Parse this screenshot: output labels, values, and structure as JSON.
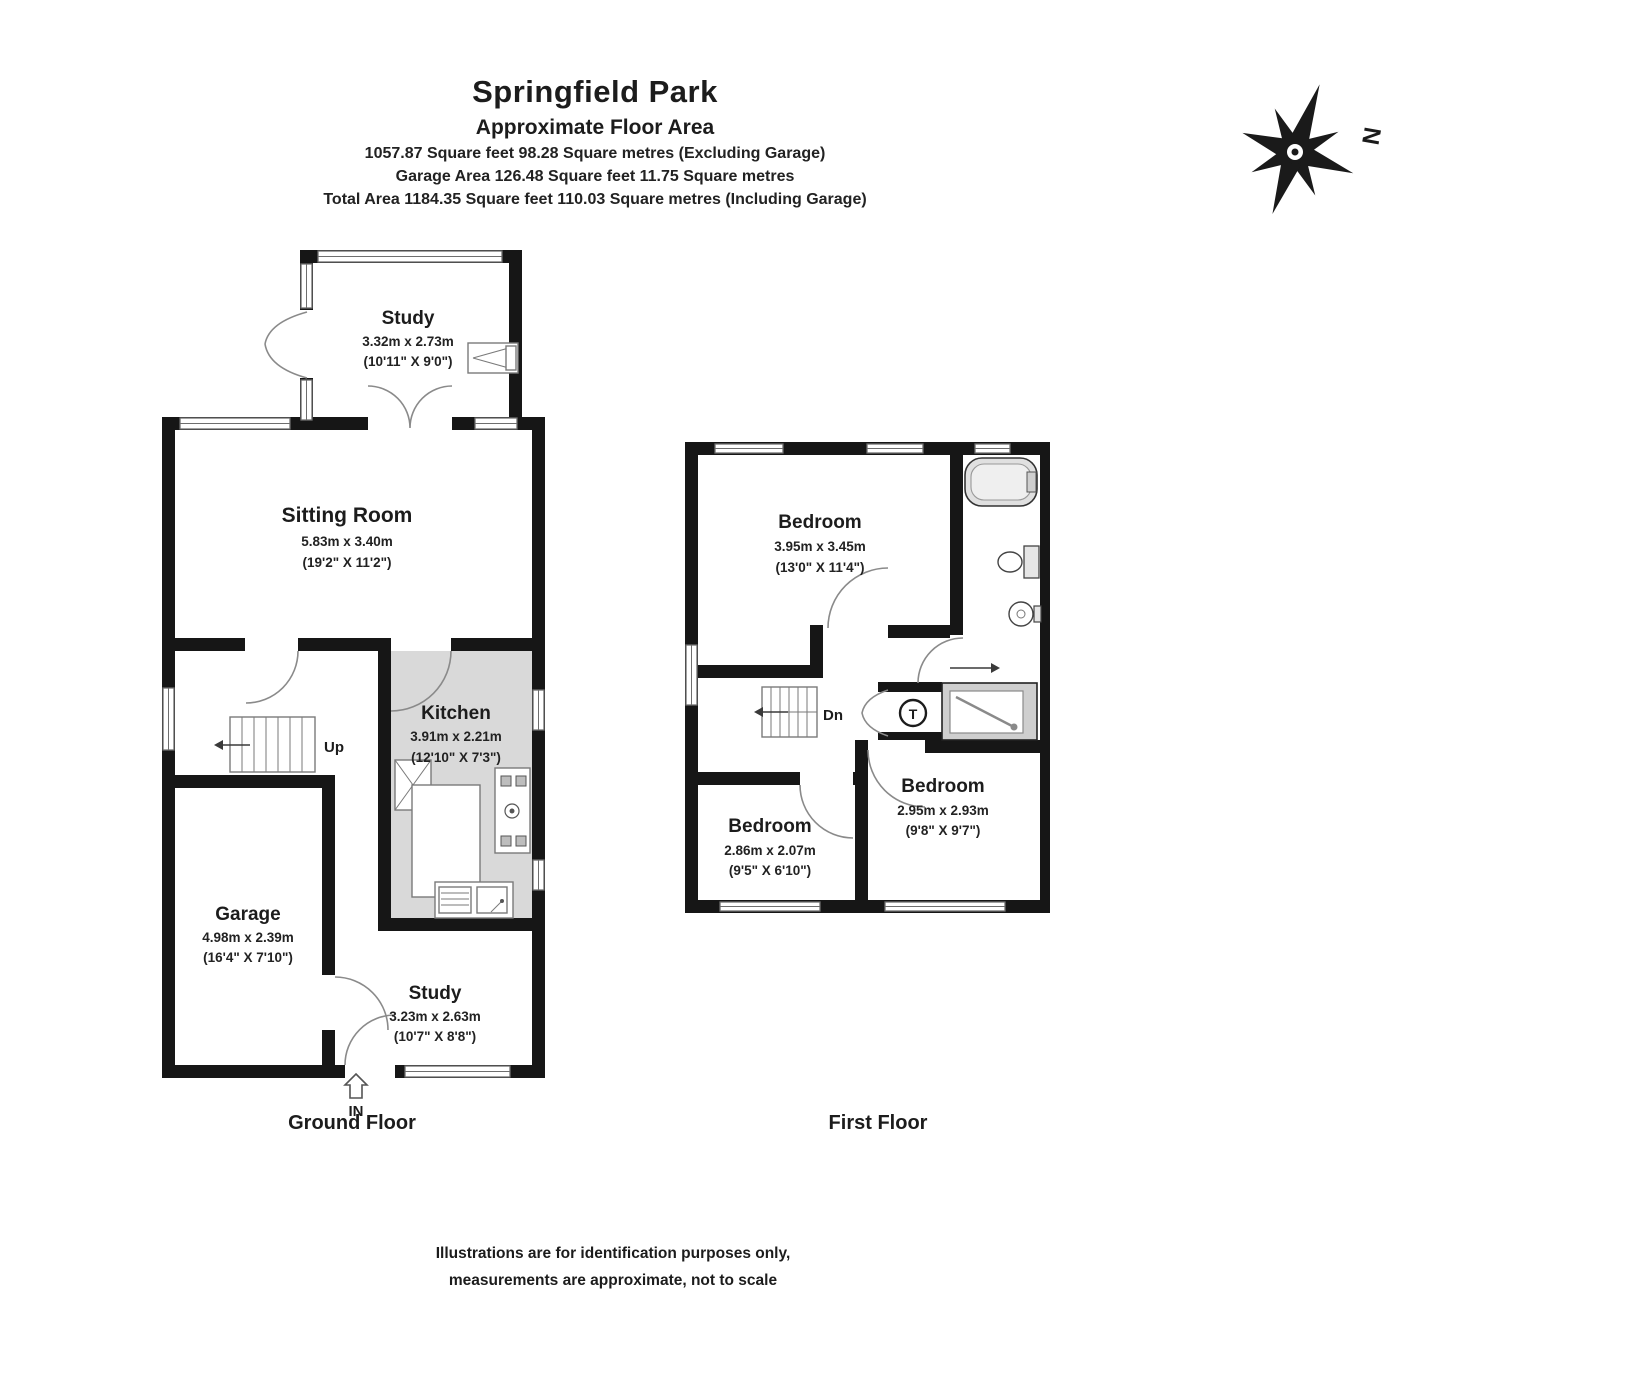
{
  "header": {
    "title": "Springfield Park",
    "subtitle": "Approximate Floor Area",
    "area_lines": [
      "1057.87 Square feet 98.28 Square metres (Excluding Garage)",
      "Garage Area 126.48 Square feet 11.75 Square metres",
      "Total Area 1184.35 Square feet 110.03 Square metres  (Including Garage)"
    ]
  },
  "compass": {
    "north_label": "N"
  },
  "ground_floor": {
    "caption": "Ground Floor",
    "stairs_label": "Up",
    "entrance_label": "IN",
    "rooms": {
      "study_top": {
        "name": "Study",
        "metric": "3.32m x 2.73m",
        "imperial": "(10'11\" X 9'0\")"
      },
      "sitting_room": {
        "name": "Sitting Room",
        "metric": "5.83m x 3.40m",
        "imperial": "(19'2\" X 11'2\")"
      },
      "kitchen": {
        "name": "Kitchen",
        "metric": "3.91m x 2.21m",
        "imperial": "(12'10\" X 7'3\")"
      },
      "garage": {
        "name": "Garage",
        "metric": "4.98m x 2.39m",
        "imperial": "(16'4\" X 7'10\")"
      },
      "study_bottom": {
        "name": "Study",
        "metric": "3.23m x 2.63m",
        "imperial": "(10'7\" X 8'8\")"
      }
    }
  },
  "first_floor": {
    "caption": "First Floor",
    "stairs_label": "Dn",
    "tank_label": "T",
    "rooms": {
      "bedroom_top": {
        "name": "Bedroom",
        "metric": "3.95m x 3.45m",
        "imperial": "(13'0\" X 11'4\")"
      },
      "bedroom_bottom_left": {
        "name": "Bedroom",
        "metric": "2.86m x 2.07m",
        "imperial": "(9'5\" X 6'10\")"
      },
      "bedroom_bottom_right": {
        "name": "Bedroom",
        "metric": "2.95m x 2.93m",
        "imperial": "(9'8\" X 9'7\")"
      }
    }
  },
  "footer": {
    "disclaimer_lines": [
      "Illustrations are for identification purposes only,",
      "measurements are approximate, not to scale"
    ]
  },
  "colors": {
    "wall": "#161616",
    "floor_shade": "#d9d9d9",
    "text": "#1c1c1c"
  }
}
